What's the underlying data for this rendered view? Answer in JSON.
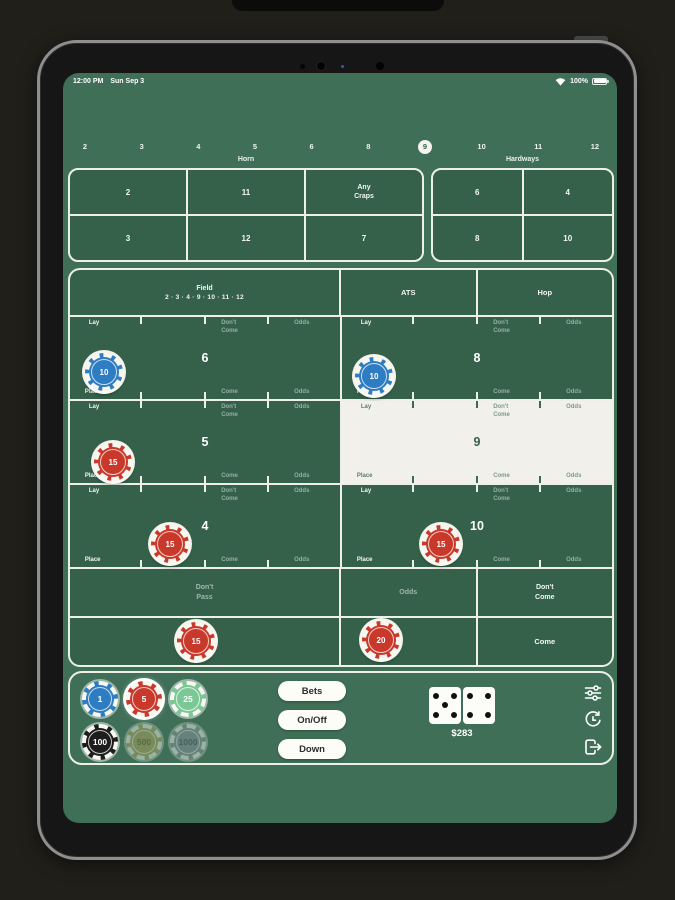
{
  "status_bar": {
    "time": "12:00 PM",
    "date": "Sun Sep 3",
    "battery_pct": "100%"
  },
  "numbers_row": {
    "values": [
      "2",
      "3",
      "4",
      "5",
      "6",
      "8",
      "9",
      "10",
      "11",
      "12"
    ],
    "point": "9"
  },
  "section_labels": {
    "horn": "Horn",
    "hardways": "Hardways"
  },
  "horn": {
    "cells": [
      "2",
      "11",
      "Any Craps",
      "3",
      "12",
      "7"
    ]
  },
  "hardways": {
    "cells": [
      "6",
      "4",
      "8",
      "10"
    ]
  },
  "field": {
    "title": "Field",
    "numbers": "2 · 3 · 4 · 9 · 10 · 11 · 12"
  },
  "ats": {
    "label": "ATS"
  },
  "hop": {
    "label": "Hop"
  },
  "labels": {
    "lay": "Lay",
    "place": "Place",
    "come": "Come",
    "odds": "Odds",
    "dont_come": "Don't Come",
    "dont_pass": "Don't Pass"
  },
  "points": {
    "six": "6",
    "eight": "8",
    "five": "5",
    "nine": "9",
    "four": "4",
    "ten": "10"
  },
  "board_chips": {
    "six": "10",
    "eight": "10",
    "five": "15",
    "four": "15",
    "ten": "15",
    "pass_line": "15",
    "come_area": "20"
  },
  "tray": {
    "chips": [
      {
        "value": "1",
        "color": "blue"
      },
      {
        "value": "5",
        "color": "red",
        "selected": true
      },
      {
        "value": "25",
        "color": "green"
      },
      {
        "value": "100",
        "color": "black"
      },
      {
        "value": "500",
        "color": "gold",
        "dim": true
      },
      {
        "value": "1000",
        "color": "gray",
        "dim": true
      }
    ],
    "buttons": {
      "bets": "Bets",
      "onoff": "On/Off",
      "down": "Down"
    },
    "dice": {
      "die1": 5,
      "die2": 4
    },
    "balance": "$283"
  },
  "colors": {
    "table_green": "#3f6f57",
    "cell_green": "#35614b",
    "border_white": "#eef0e8",
    "chip_blue": "#2e7dc2",
    "chip_red": "#c8392b",
    "chip_green": "#7bc795",
    "chip_black": "#1d1d1d",
    "chip_gold": "#b4a75e",
    "chip_gray": "#8e94a0",
    "point_highlight": "#f1f0ea"
  }
}
